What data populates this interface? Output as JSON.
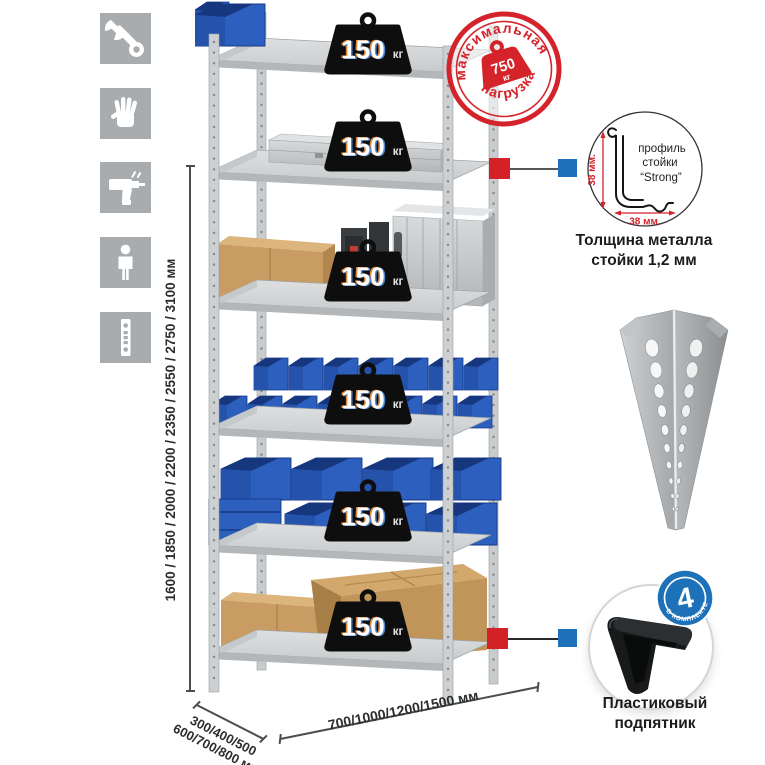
{
  "colors": {
    "accent_red": "#d42027",
    "accent_blue": "#1d71b8",
    "stamp_red": "#d5232b",
    "bin_blue": "#2c5fbe",
    "metal_gray": "#d7dadb",
    "cardboard": "#c89c63",
    "icon_tile_gray": "#a8acaf",
    "badge_black": "#0e0e0e"
  },
  "icons_panel": {
    "items": [
      {
        "name": "wrench-icon"
      },
      {
        "name": "gloves-icon"
      },
      {
        "name": "drill-icon"
      },
      {
        "name": "person-icon"
      },
      {
        "name": "post-strip-icon"
      }
    ]
  },
  "rack": {
    "shelf_count": 6,
    "load_value": "150",
    "load_unit": "кг"
  },
  "stamp": {
    "arc_top": "максимальная",
    "arc_bottom": "нагрузка",
    "value": "750",
    "unit": "кг"
  },
  "profile_detail": {
    "line1": "профиль",
    "line2": "стойки",
    "line3": "“Strong”",
    "dim_vertical": "38 мм.",
    "dim_horizontal": "38 мм.",
    "caption1": "Толщина металла",
    "caption2": "стойки 1,2 мм"
  },
  "foot_detail": {
    "count": "4",
    "arc_text": "в комплекте",
    "caption1": "Пластиковый",
    "caption2": "подпятник"
  },
  "dimensions": {
    "height": "1600 / 1850 / 2000 / 2200 / 2350 / 2550 / 2750 / 3100 мм",
    "depth1": "300/400/500",
    "depth2": "600/700/800 мм",
    "width": "700/1000/1200/1500 мм"
  }
}
